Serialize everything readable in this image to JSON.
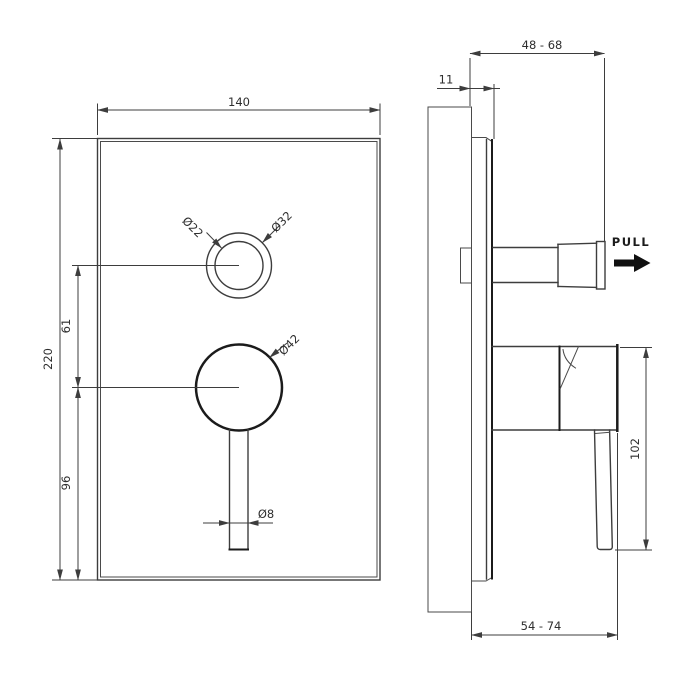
{
  "front_view": {
    "plate_width": "140",
    "plate_height": "220",
    "diverter_to_handle_offset": "61",
    "handle_to_bottom_offset": "96",
    "diverter_inner_diameter": "Ø22",
    "diverter_outer_diameter": "Ø32",
    "handle_base_diameter": "Ø42",
    "lever_stem_diameter": "Ø8"
  },
  "side_view": {
    "wall_to_diverter_depth_range": "48 - 68",
    "plate_projection_from_wall": "11",
    "handle_assembly_height": "102",
    "wall_to_handle_depth_range": "54 - 74",
    "pull_label": "PULL"
  },
  "colors": {
    "line": "#3d3d3d",
    "bold_line": "#1b1b1b",
    "arrow_fill": "#101010",
    "background": "#ffffff"
  }
}
